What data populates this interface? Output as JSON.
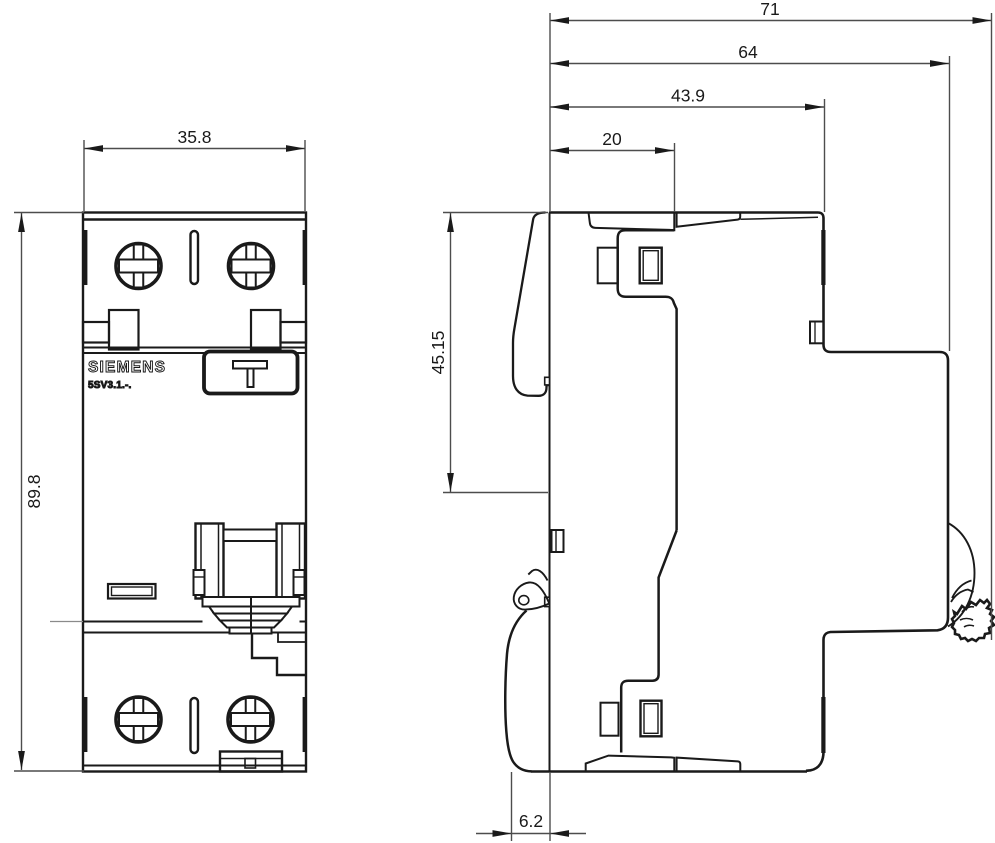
{
  "labels": {
    "brand": "SIEMENS",
    "model": "5SV3.1.-."
  },
  "dimensions": {
    "front_width": "35.8",
    "front_height": "89.8",
    "total_depth": "71",
    "body_depth": "64",
    "front_depth": "43.9",
    "front_section_depth": "20",
    "cutout_height": "45.15",
    "clip_offset": "6.2"
  },
  "colors": {
    "line": "#1a1a1a",
    "dim_line": "#4d4d4d",
    "background": "#ffffff"
  }
}
